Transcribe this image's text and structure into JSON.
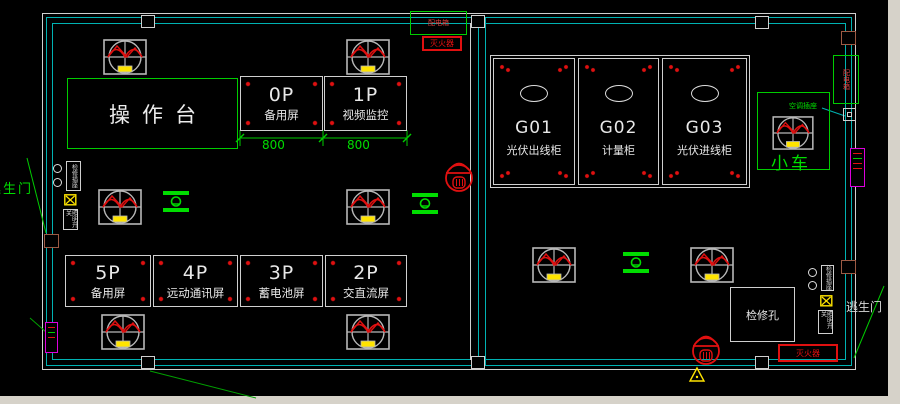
{
  "floor_plan": {
    "console": {
      "label": "操作台"
    },
    "top_panels": [
      {
        "id": "0P",
        "name": "备用屏"
      },
      {
        "id": "1P",
        "name": "视频监控"
      }
    ],
    "dimensions": {
      "d1": "800",
      "d2": "800"
    },
    "bottom_panels": [
      {
        "id": "5P",
        "name": "备用屏"
      },
      {
        "id": "4P",
        "name": "远动通讯屏"
      },
      {
        "id": "3P",
        "name": "蓄电池屏"
      },
      {
        "id": "2P",
        "name": "交直流屏"
      }
    ],
    "cabinets": [
      {
        "id": "G01",
        "name": "光伏出线柜"
      },
      {
        "id": "G02",
        "name": "计量柜"
      },
      {
        "id": "G03",
        "name": "光伏进线柜"
      }
    ],
    "annotations": {
      "trolley": "小车",
      "inspection_hatch": "检修孔",
      "fire_extinguisher_top": "灭火器",
      "fire_extinguisher_bottom": "灭火器",
      "distribution_box_top": "配电箱",
      "distribution_box_right": "配电箱",
      "ac_socket": "空调插座",
      "escape_door_left": "逃生门",
      "escape_door_right": "逃生门",
      "wall_socket_left": "检修插座",
      "wall_switch_left": "照明开关",
      "wall_socket_right": "检修插座",
      "wall_switch_right": "照明开关"
    },
    "colors": {
      "wall": "#00b2b2",
      "outline": "#cfcfcf",
      "highlight": "#00dd00",
      "alert": "#e01010",
      "accent": "#ffff00",
      "vent": "#dd00dd"
    }
  }
}
